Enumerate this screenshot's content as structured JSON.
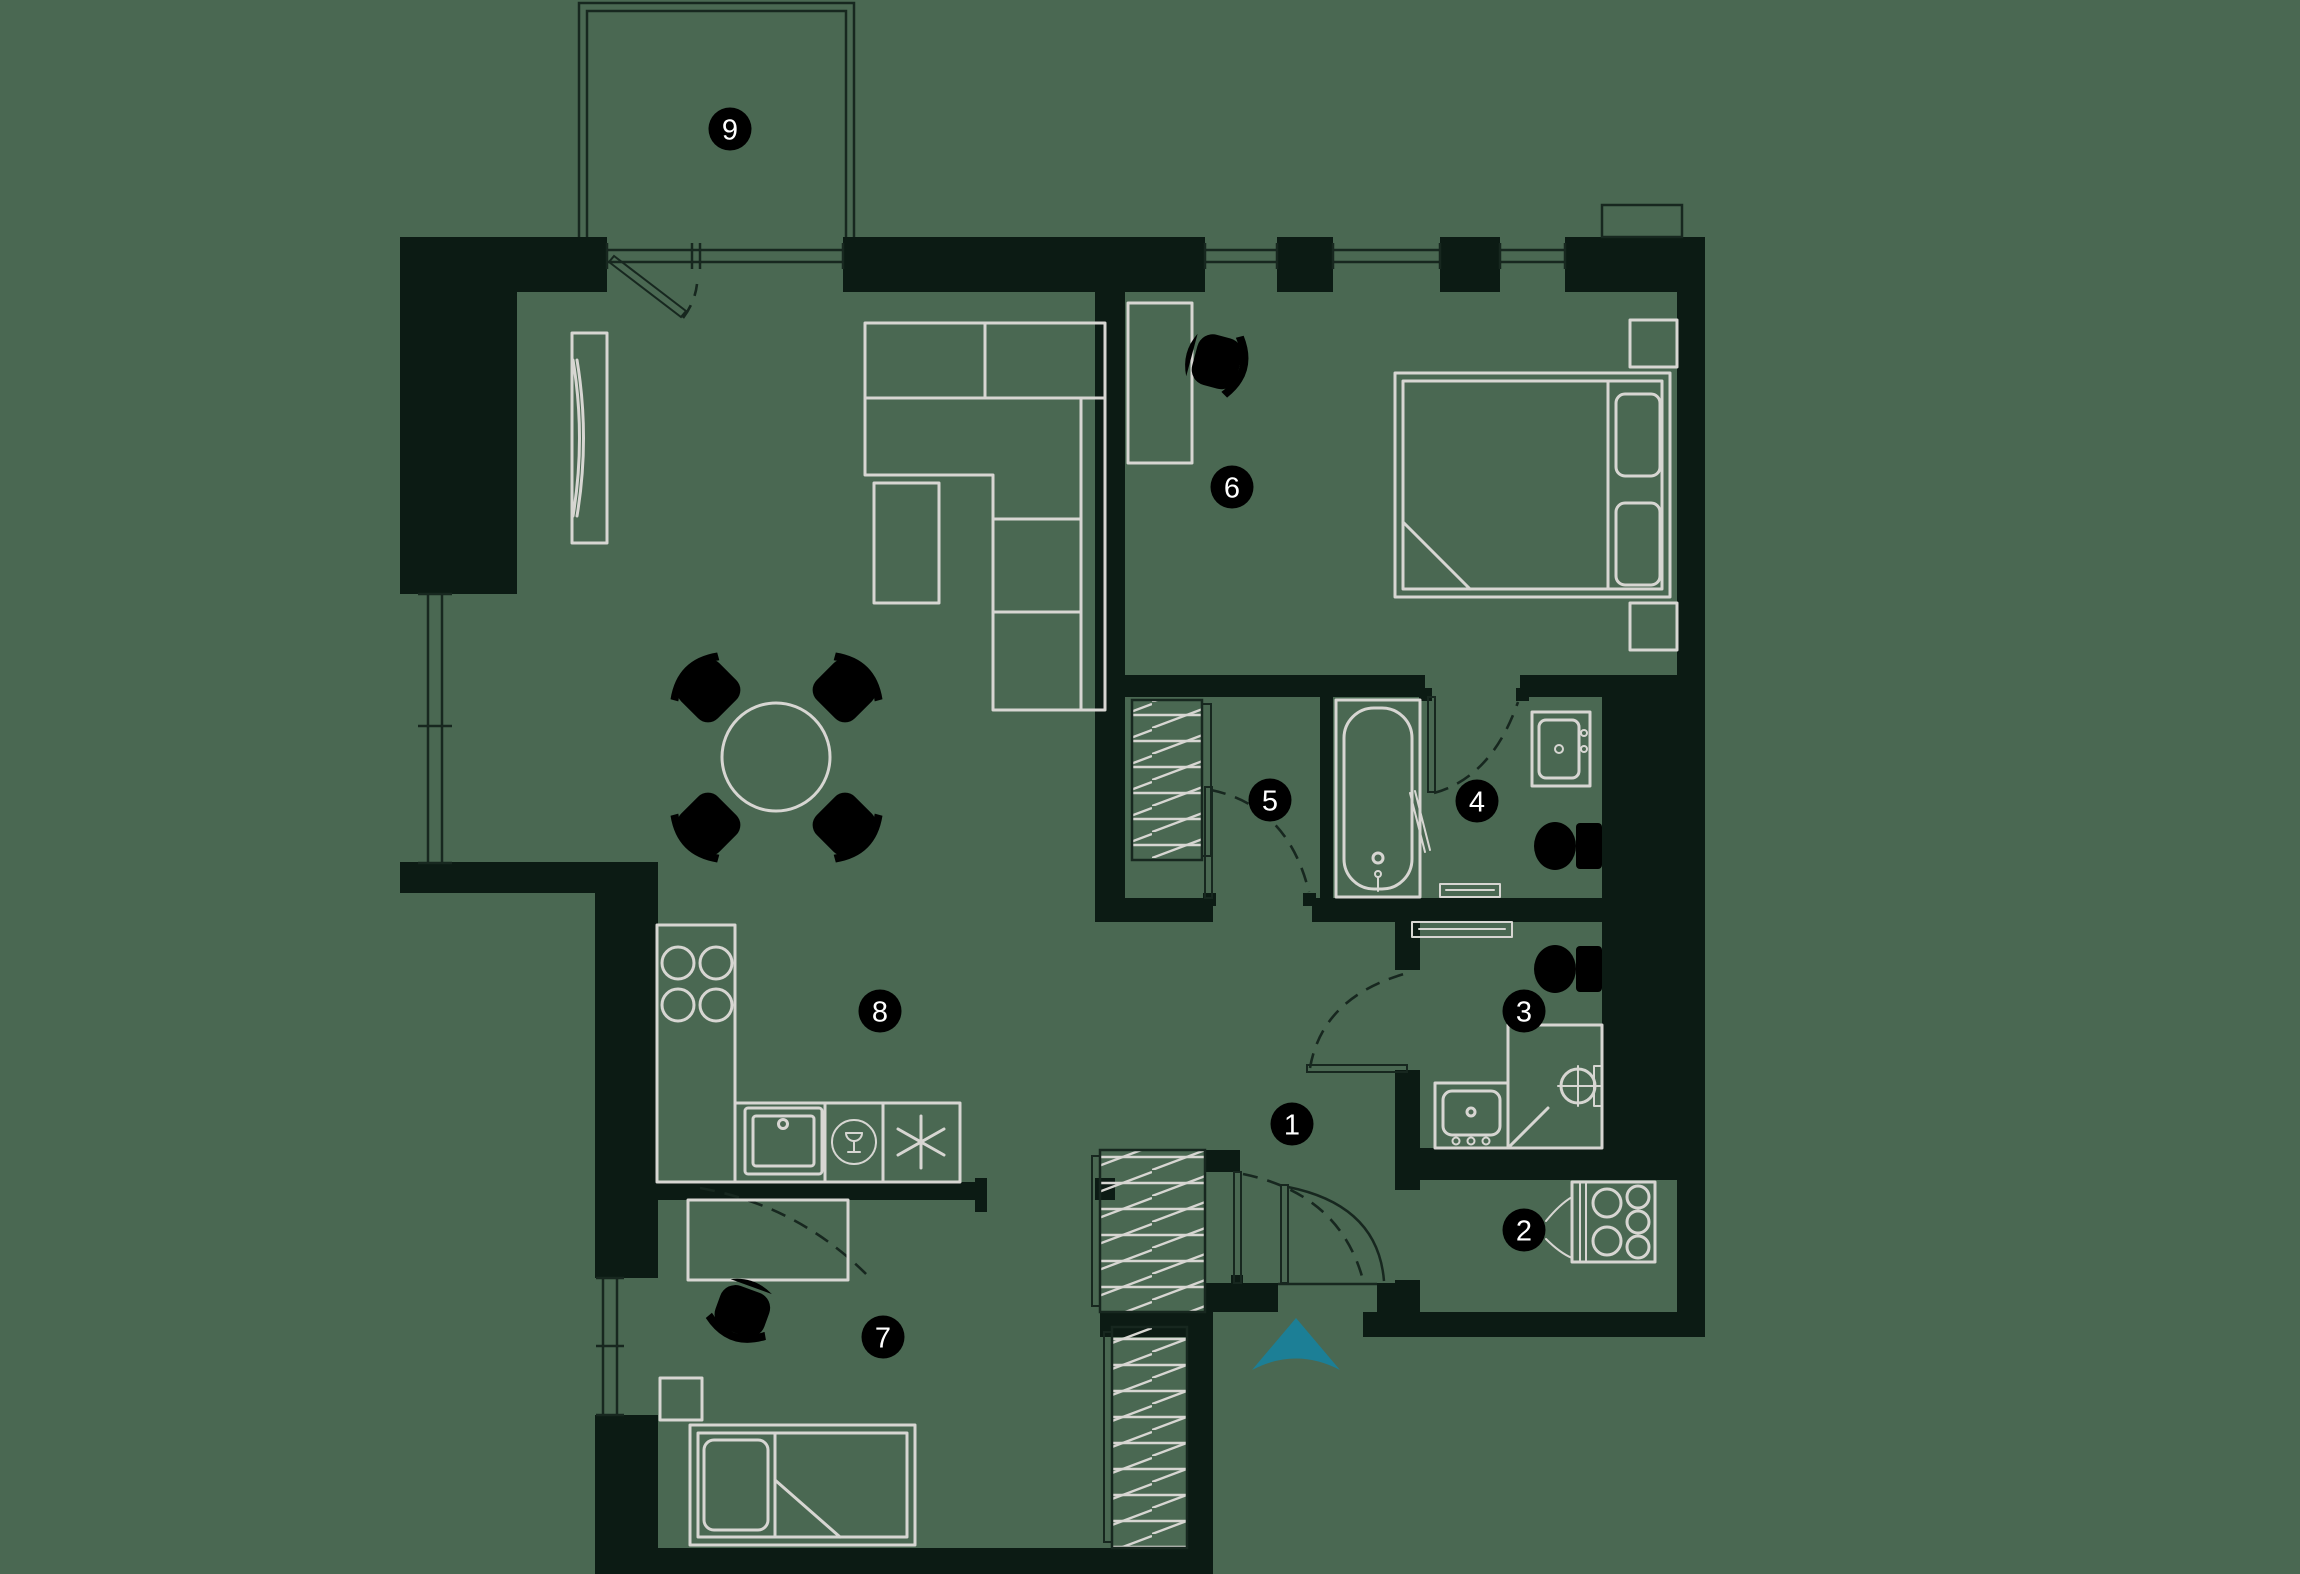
{
  "floorplan": {
    "type": "apartment-floor-plan",
    "colors": {
      "background": "#4a6852",
      "walls": "#0c1b14",
      "lines": "#17271f",
      "furniture": "#d7d6d2",
      "badge_bg": "#000000",
      "badge_text": "#ffffff",
      "entrance_arrow": "#1c7f96"
    },
    "badge_radius": 21.5,
    "rooms": [
      {
        "number": "1",
        "x": 1292,
        "y": 1124
      },
      {
        "number": "2",
        "x": 1524,
        "y": 1230
      },
      {
        "number": "3",
        "x": 1524,
        "y": 1011
      },
      {
        "number": "4",
        "x": 1477,
        "y": 801
      },
      {
        "number": "5",
        "x": 1270,
        "y": 800
      },
      {
        "number": "6",
        "x": 1232,
        "y": 487
      },
      {
        "number": "7",
        "x": 883,
        "y": 1337
      },
      {
        "number": "8",
        "x": 880,
        "y": 1011
      },
      {
        "number": "9",
        "x": 730,
        "y": 129
      }
    ],
    "entrance": {
      "icon": "arrow-up",
      "color": "#1c7f96"
    }
  }
}
